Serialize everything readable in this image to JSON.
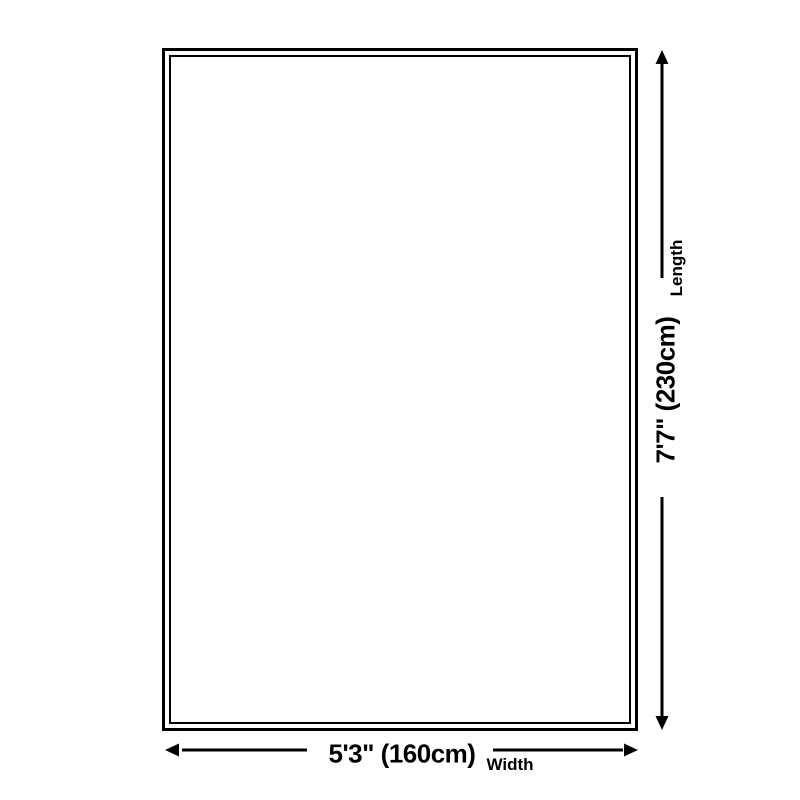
{
  "diagram": {
    "length_dimension": {
      "label": "Length",
      "value": "7'7\" (230cm)"
    },
    "width_dimension": {
      "label": "Width",
      "value": "5'3\" (160cm)"
    },
    "colors": {
      "outline": "#000000",
      "text": "#000000",
      "background": "#ffffff"
    }
  }
}
